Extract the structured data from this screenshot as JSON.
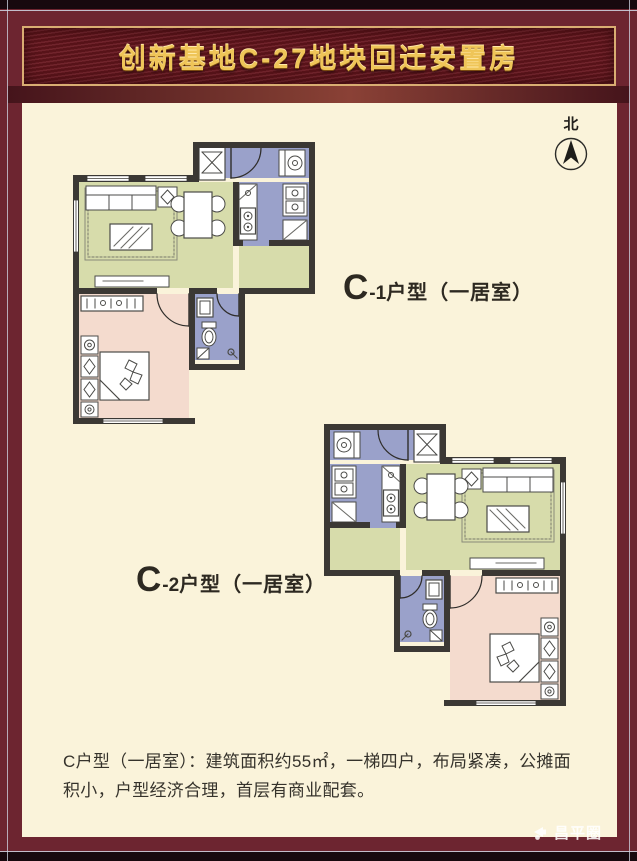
{
  "banner": {
    "title": "创新基地C-27地块回迁安置房"
  },
  "north": {
    "label": "北"
  },
  "plans": [
    {
      "id": "C-1",
      "label_main": "C",
      "label_sub": "-1",
      "label_rest": "户型（一居室）"
    },
    {
      "id": "C-2",
      "label_main": "C",
      "label_sub": "-2",
      "label_rest": "户型（一居室）"
    }
  ],
  "description": {
    "text": "C户型（一居室）：建筑面积约55㎡，一梯四户，布局紧凑，公摊面积小，户型经济合理，首层有商业配套。"
  },
  "watermark": {
    "text": "昌平圈"
  },
  "colors": {
    "frame_maroon": "#6d2530",
    "banner_gold_border": "#d9ad72",
    "banner_text_gold": "#efc558",
    "panel_cream": "#faf3da",
    "living_green": "#d7dcab",
    "bedroom_pink": "#f4dbce",
    "kitchen_bath_blue": "#9aa1ca",
    "wall_dark": "#3b3834"
  }
}
